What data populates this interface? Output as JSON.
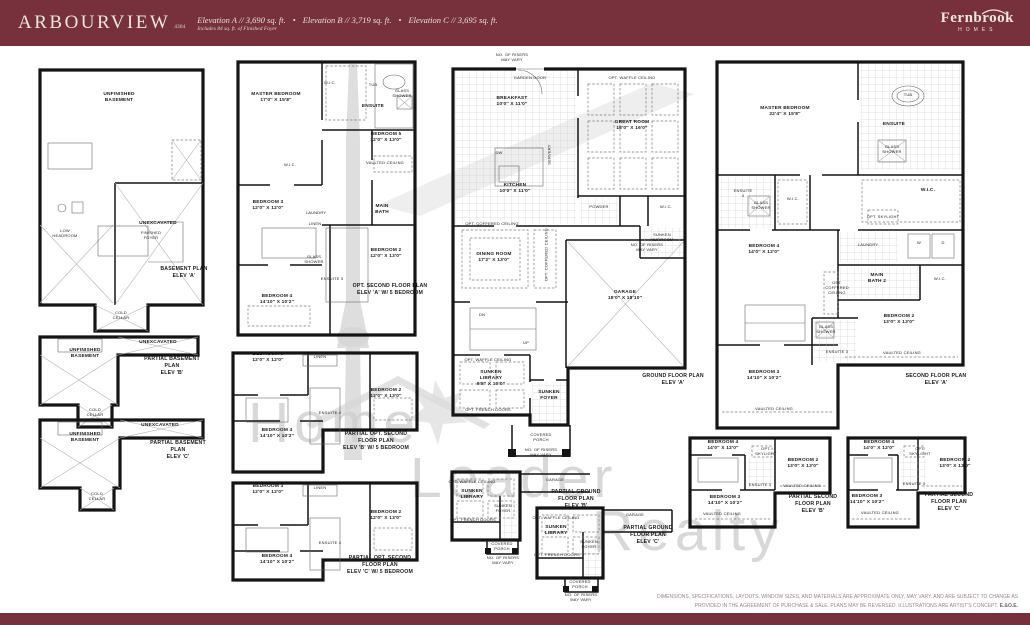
{
  "header": {
    "title": "ARBOURVIEW",
    "model_number": "4304",
    "elevation_a": "Elevation A // 3,690 sq. ft.",
    "elevation_b": "Elevation B // 3,719 sq. ft.",
    "elevation_c": "Elevation C // 3,695 sq. ft.",
    "bullet": "•",
    "subnote": "Includes 84 sq. ft. of Finished Foyer",
    "brand": {
      "name": "Fernbrook",
      "sub": "HOMES"
    },
    "bar_color": "#76313d"
  },
  "watermark": {
    "word1": "Home",
    "word2": "Leader",
    "word3": "Realty"
  },
  "footer": {
    "line1": "DIMENSIONS, SPECIFICATIONS, LAYOUTS, WINDOW SIZES, AND MATERIALS ARE APPROXIMATE ONLY, MAY VARY, AND ARE SUBJECT TO CHANGE AS",
    "line2": "PROVIDED IN THE AGREEMENT OF PURCHASE & SALE. PLANS MAY BE REVERSED. ILLUSTRATIONS ARE ARTIST'S CONCEPT.",
    "eoe": "E.&O.E."
  },
  "labels": {
    "b_unfinished": "UNFINISHED\nBASEMENT",
    "b_low": "LOW\nHEADROOM",
    "b_foyer": "FINISHED\nFOYER",
    "b_unex": "UNEXCAVATED",
    "b_cold": "COLD\nCELLAR",
    "b_caption": "BASEMENT PLAN\nELEV 'A'",
    "pb_b_unfinished": "UNFINISHED\nBASEMENT",
    "pb_b_unex": "UNEXCAVATED",
    "pb_b_cold": "COLD\nCELLAR",
    "pb_b_caption": "PARTIAL BASEMENT PLAN\nELEV 'B'",
    "pb_c_unfinished": "UNFINISHED\nBASEMENT",
    "pb_c_unex": "UNEXCAVATED",
    "pb_c_cold": "COLD\nCELLAR",
    "pb_c_caption": "PARTIAL BASEMENT PLAN\nELEV 'C'",
    "o_master": "MASTER BEDROOM\n17'0″ X 15'8″",
    "o_wic1": "W.I.C.",
    "o_tub": "TUB",
    "o_glass1": "GLASS\nSHOWER",
    "o_ensuite": "ENSUITE",
    "o_bed5": "BEDROOM 5\n12'0″ X 13'0″",
    "o_vault5": "VAULTED CEILING",
    "o_wic2": "W.I.C.",
    "o_bed3": "BEDROOM 3\n12'0″ X 12'0″",
    "o_laundry": "LAUNDRY",
    "o_linen": "LINEN",
    "o_bath": "MAIN\nBATH",
    "o_bed2": "BEDROOM 2\n12'0″ X 13'0″",
    "o_glass2": "GLASS\nSHOWER",
    "o_ensuite3": "ENSUITE 3",
    "o_bed4": "BEDROOM 4\n14'10″ X 10'2″",
    "o_caption": "OPT. SECOND FLOOR PLAN\nELEV 'A' W/ 5 BEDROOM",
    "po_b_bed3": "BEDROOM 3\n12'0″ X 12'0″",
    "po_b_linen": "LINEN",
    "po_b_bed2": "BEDROOM 2\n12'0″ X 13'0″",
    "po_b_ens4": "ENSUITE 4",
    "po_b_bed4": "BEDROOM 4\n14'10″ X 10'2″",
    "po_b_caption": "PARTIAL OPT. SECOND FLOOR PLAN\nELEV 'B' W/ 5 BEDROOM",
    "po_c_bed3": "BEDROOM 3\n12'0″ X 12'0″",
    "po_c_linen": "LINEN",
    "po_c_bed2": "BEDROOM 2\n12'0″ X 13'0″",
    "po_c_ens4": "ENSUITE 4",
    "po_c_bed4": "BEDROOM 4\n14'10″ X 10'2″",
    "po_c_caption": "PARTIAL OPT. SECOND FLOOR PLAN\nELEV 'C' W/ 5 BEDROOM",
    "g_no_risers_top": "NO. OF RISERS\nMAY VARY",
    "g_garden_door": "GARDEN DOOR",
    "g_breakfast": "BREAKFAST\n10'0″ X 11'0″",
    "g_opt_waffle_great": "OPT. WAFFLE CEILING",
    "g_great_room": "GREAT ROOM\n18'0″ X 16'0″",
    "g_dw": "DW",
    "g_servery": "SERVERY",
    "g_kitchen": "KITCHEN\n10'0″ X 11'0″",
    "g_powder": "POWDER",
    "g_wic": "W.I.C.",
    "g_mudroom": "SUNKEN\nMUDROOM",
    "g_opt_coffered_dining": "OPT. COFFERED CEILING",
    "g_dining": "DINING ROOM\n17'2″ X 13'0″",
    "g_opt_coffered_vert": "OPT. COFFERED CEILING",
    "g_garage": "GARAGE\n18'0″ X 18'10″",
    "g_no_risers_garage": "NO. OF RISERS\nMAY VARY",
    "g_dn": "DN",
    "g_up": "UP",
    "g_opt_waffle_lib": "OPT. WAFFLE CEILING",
    "g_library": "SUNKEN\nLIBRARY\n9'8″ X 10'0″",
    "g_opt_french": "OPT. FRENCH DOORS",
    "g_foyer": "SUNKEN\nFOYER",
    "g_porch": "COVERED\nPORCH",
    "g_no_risers_porch": "NO. OF RISERS\nMAY VARY",
    "g_caption": "GROUND FLOOR PLAN\nELEV 'A'",
    "pg_b_waffle": "OPT. WAFFLE CEILING",
    "pg_b_library": "SUNKEN\nLIBRARY",
    "pg_b_french": "OPT. FRENCH DOORS",
    "pg_b_foyer": "SUNKEN\nFOYER",
    "pg_b_garage": "GARAGE",
    "pg_b_porch": "COVERED\nPORCH",
    "pg_b_risers": "NO. OF RISERS\nMAY VARY",
    "pg_b_caption": "PARTIAL GROUND FLOOR PLAN\nELEV 'B'",
    "pg_c_waffle": "OPT. WAFFLE CEILING",
    "pg_c_library": "SUNKEN\nLIBRARY",
    "pg_c_french": "OPT. FRENCH DOORS",
    "pg_c_foyer": "SUNKEN\nFOYER",
    "pg_c_garage": "GARAGE",
    "pg_c_porch": "COVERED\nPORCH",
    "pg_c_risers": "NO. OF RISERS\nMAY VARY",
    "pg_c_caption": "PARTIAL GROUND FLOOR PLAN\nELEV 'C'",
    "s_master": "MASTER BEDROOM\n22'4″ X 15'8″",
    "s_tub": "TUB",
    "s_ensuite": "ENSUITE",
    "s_glass1": "GLASS\nSHOWER",
    "s_wic1": "W.I.C.",
    "s_ensuite4": "ENSUITE\n4",
    "s_glass2": "GLASS\nSHOWER",
    "s_wic2": "W.I.C.",
    "s_skylight": "OPT. SKYLIGHT",
    "s_laundry": "LAUNDRY",
    "s_w": "W",
    "s_d": "D",
    "s_bed4": "BEDROOM 4\n14'0″ X 12'0″",
    "s_bath2": "MAIN\nBATH 2",
    "s_wic3": "W.I.C.",
    "s_coffered": "OPT.\nCOFFERED\nCEILING",
    "s_bed2": "BEDROOM 2\n13'0″ X 13'0″",
    "s_glass3": "GLASS\nSHOWER",
    "s_ensuite3": "ENSUITE 3",
    "s_vault2": "VAULTED CEILING",
    "s_bed3": "BEDROOM 3\n14'10″ X 10'2″",
    "s_vault3": "VAULTED CEILING",
    "s_caption": "SECOND FLOOR PLAN\nELEV 'A'",
    "ps_b_bed4": "BEDROOM 4\n14'0″ X 12'0″",
    "ps_b_sky": "OPT.\nSKYLIGHT",
    "ps_b_bed2": "BEDROOM 2\n13'0″ X 13'0″",
    "ps_b_ens3": "ENSUITE 3",
    "ps_b_vault": "VAULTED CEILING",
    "ps_b_bed3": "BEDROOM 3\n14'10″ X 10'2″",
    "ps_b_vault2": "VAULTED CEILING",
    "ps_b_caption": "PARTIAL SECOND FLOOR PLAN\nELEV 'B'",
    "ps_c_bed4": "BEDROOM 4\n14'0″ X 12'0″",
    "ps_c_sky": "OPT.\nSKYLIGHT",
    "ps_c_bed2": "BEDROOM 2\n13'0″ X 13'0″",
    "ps_c_ens3": "ENSUITE 3",
    "ps_c_bed3": "BEDROOM 3\n14'10″ X 10'2″",
    "ps_c_vault": "VAULTED CEILING",
    "ps_c_caption": "PARTIAL SECOND FLOOR PLAN\nELEV 'C'"
  }
}
